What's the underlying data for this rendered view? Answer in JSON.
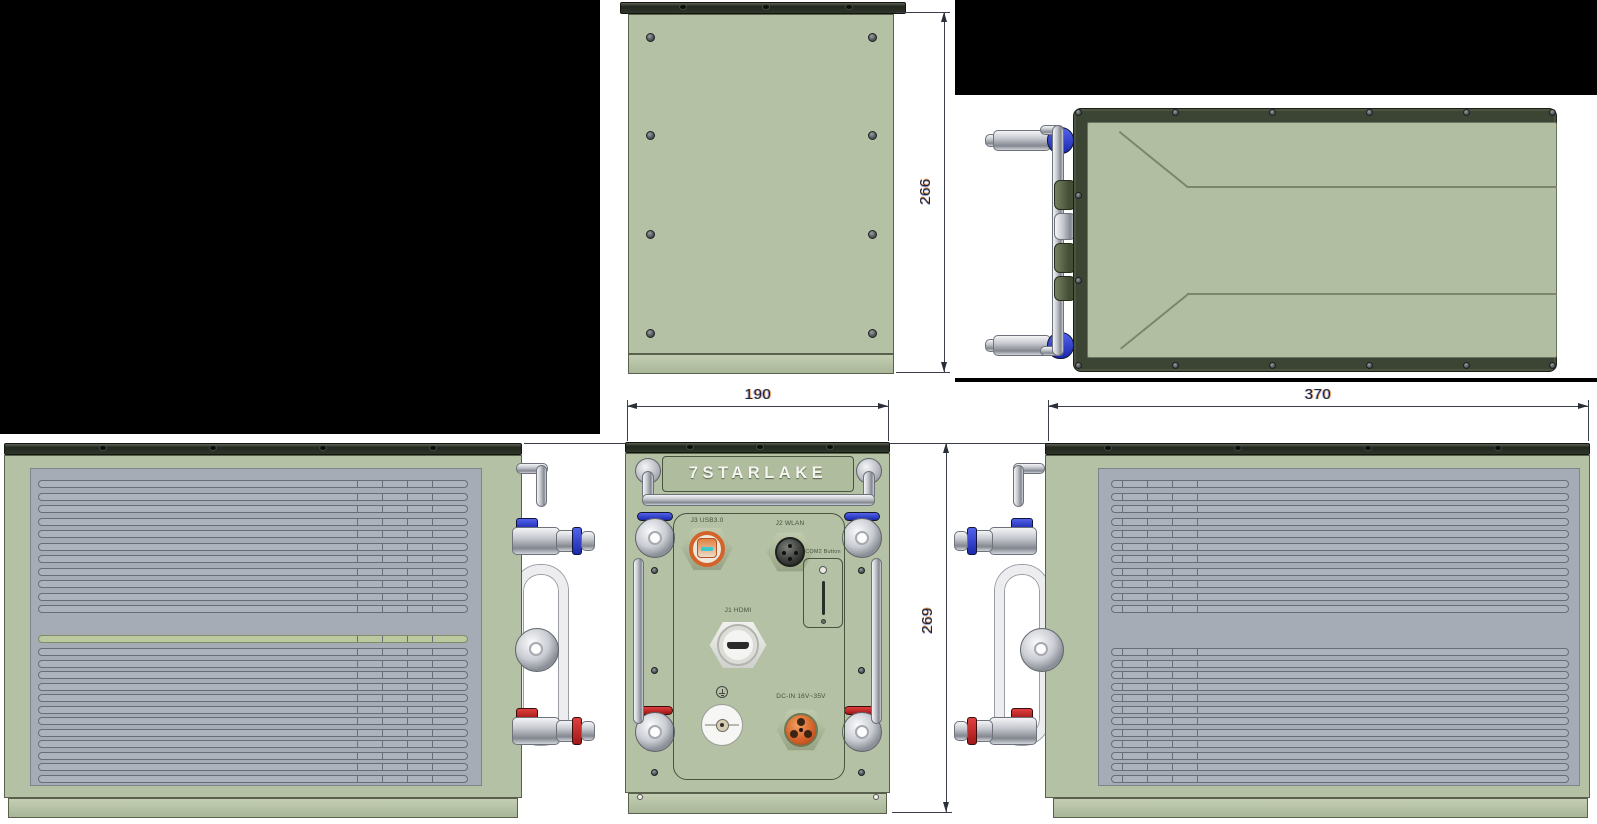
{
  "page": {
    "width": 1597,
    "height": 824,
    "background": "#000000"
  },
  "brand": {
    "logo_text": "7STARLAKE"
  },
  "views": {
    "rear": {
      "dim_height": "266",
      "screw_cols": 2,
      "screw_rows": 4
    },
    "top": {},
    "front": {
      "dim_width": "190",
      "dim_height": "269",
      "labels": {
        "usb": "J3 USB3.0",
        "wlan": "J2 WLAN",
        "button": "COM2 Button",
        "hdmi": "J1 HDMI",
        "dc_in": "DC-IN 16V~35V"
      }
    },
    "left_side": {
      "slats_upper": 11,
      "slats_lower": 12,
      "slats_highlight": 1
    },
    "right_side": {
      "dim_length": "370",
      "slats_upper": 11,
      "slats_lower": 12
    }
  },
  "colors": {
    "chassis_sage": "#b5c1a5",
    "frame_olive": "#3c4533",
    "cap_dark": "#2e352a",
    "radiator_gray": "#a6acb5",
    "slat_gray": "#adb3bc",
    "slat_green": "#bbc8a0",
    "coolant_blue": "#2636cf",
    "coolant_red": "#c32525",
    "connector_orange": "#dd6a2e",
    "usb_cyan": "#3cc8cf",
    "logo_text_color": "#f5f5f0",
    "dim_text": "#1f2430"
  }
}
